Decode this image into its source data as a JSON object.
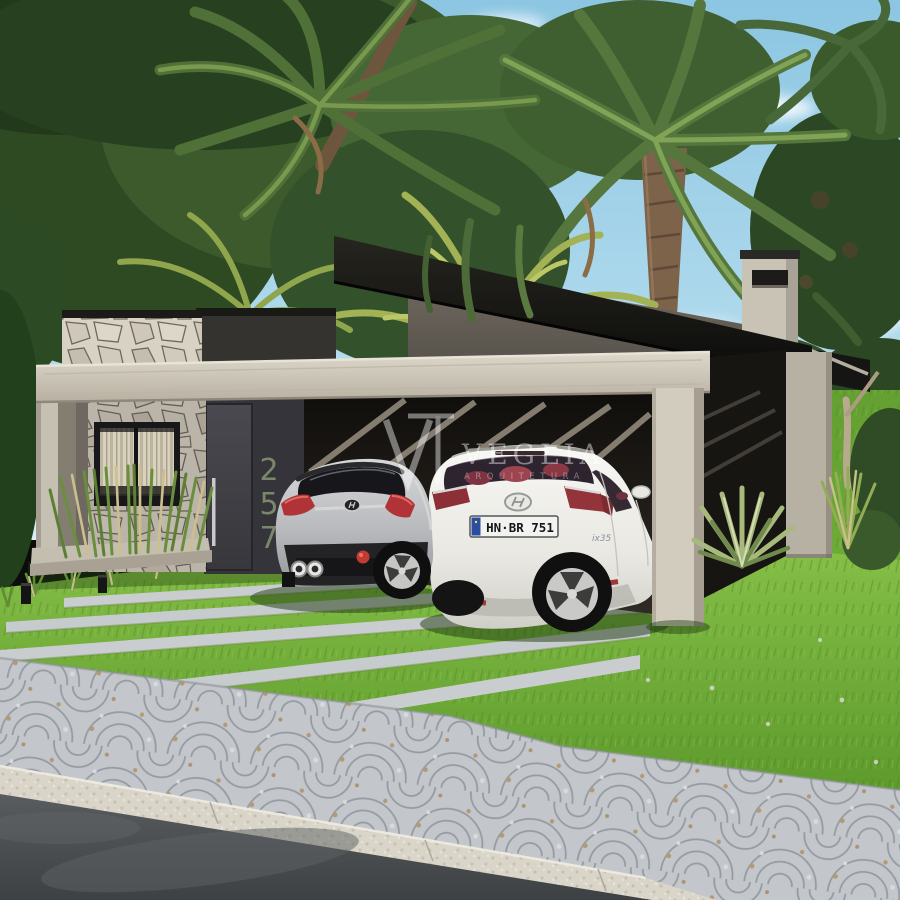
{
  "scene": {
    "type": "architectural exterior rendering",
    "description": "Modern single-story house with stone feature wall, charcoal facade, black skillion roof carport sheltering two cars, tropical palm garden, lawn with concrete wheel strips, Portuguese cobblestone driveway and asphalt street"
  },
  "watermark": {
    "logo_mark": "VT",
    "name": "VEGLIA",
    "subtitle": "ARQUITETURA"
  },
  "house": {
    "number": "257",
    "digits": [
      "2",
      "5",
      "7"
    ]
  },
  "vehicles": {
    "hatchback": {
      "color_name": "silver",
      "position": "left carport bay"
    },
    "suv": {
      "color_name": "white",
      "plate": "HN·BR 751",
      "badge": "ix35",
      "position": "right carport bay"
    }
  },
  "palette": {
    "sky": "#8cc6e2",
    "foliage_dark": "#2e4a22",
    "foliage_light": "#9ab050",
    "roof": "#141413",
    "concrete_frame": "#d0cabd",
    "charcoal_wall": "#3a393d",
    "stone": "#d8d2c5",
    "lawn": "#6fae3a",
    "cobblestone": "#c3c7cb",
    "asphalt": "#4e5154",
    "house_number": "#7e8d6d"
  }
}
